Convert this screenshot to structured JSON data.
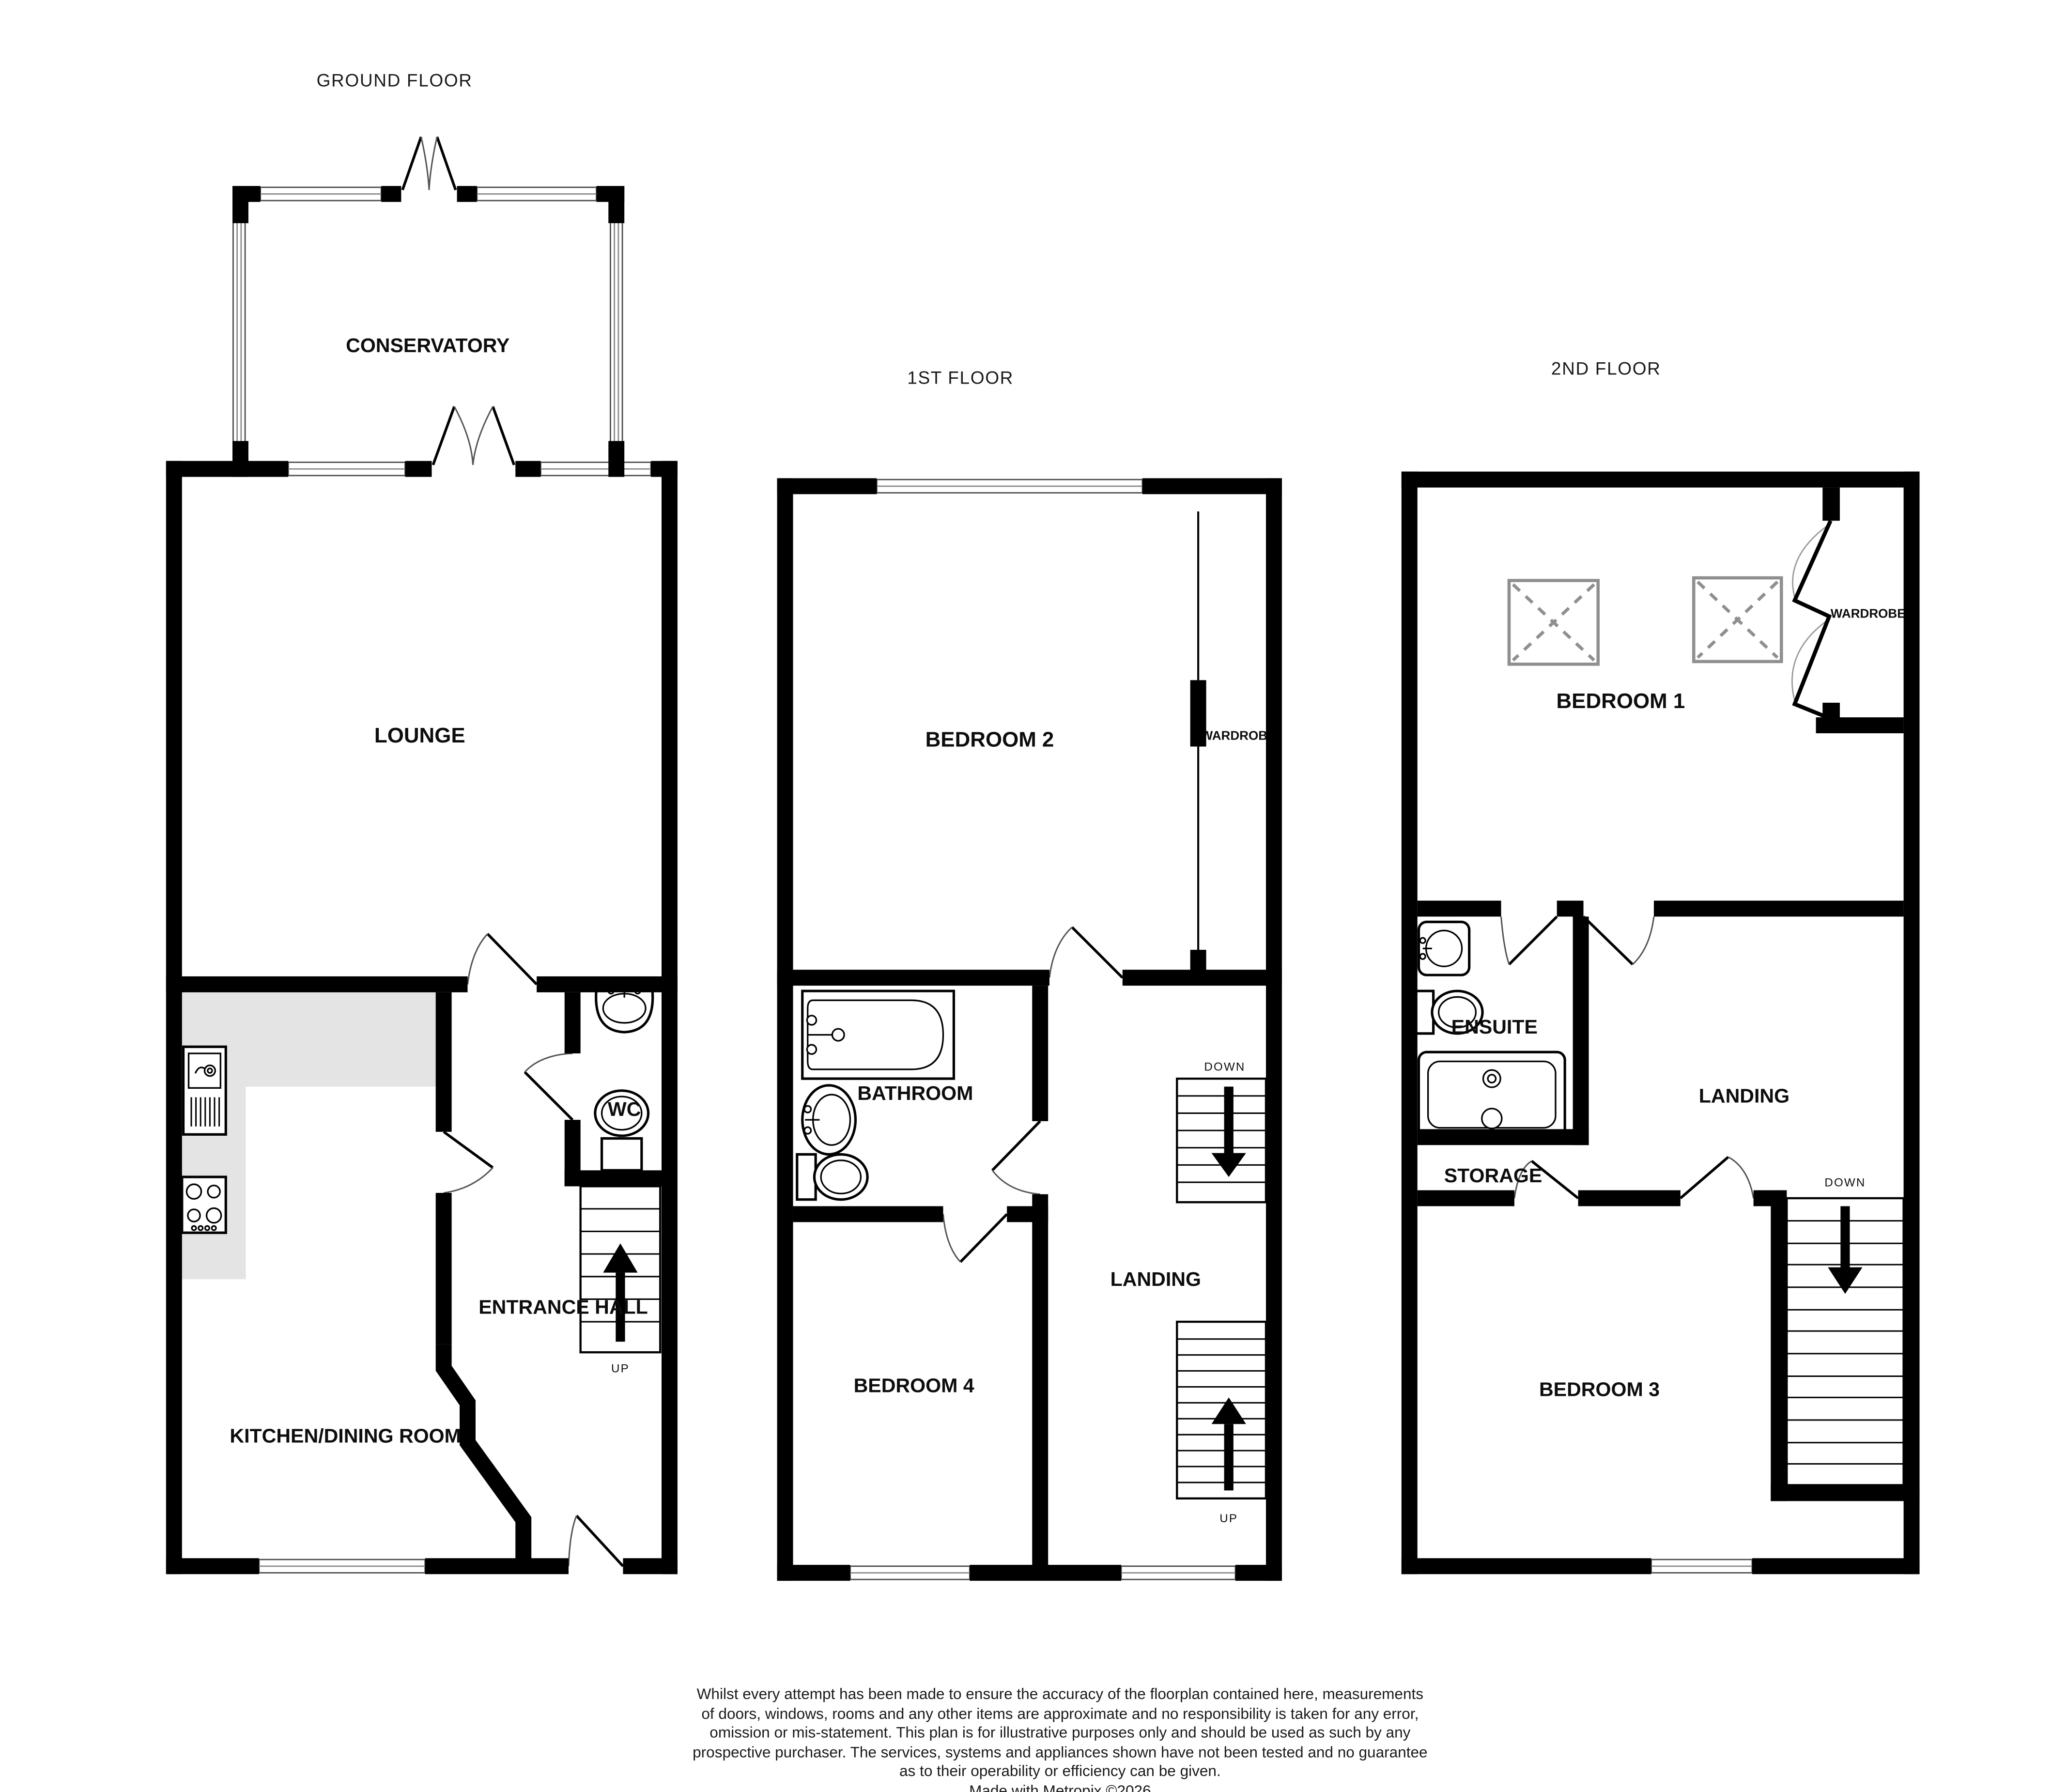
{
  "colors": {
    "wall": "#000000",
    "counter": "#e4e4e4",
    "skylight": "#8f8f8f",
    "background": "#ffffff"
  },
  "ground": {
    "title": "GROUND FLOOR",
    "labels": {
      "conservatory": "CONSERVATORY",
      "lounge": "LOUNGE",
      "kitchen": "KITCHEN/DINING ROOM",
      "wc": "WC",
      "entrance_hall": "ENTRANCE HALL"
    },
    "stairs": {
      "up": "UP"
    }
  },
  "first": {
    "title": "1ST FLOOR",
    "labels": {
      "bedroom2": "BEDROOM 2",
      "wardrobe": "WARDROBE",
      "bathroom": "BATHROOM",
      "landing": "LANDING",
      "bedroom4": "BEDROOM 4"
    },
    "stairs": {
      "down": "DOWN",
      "up": "UP"
    }
  },
  "second": {
    "title": "2ND FLOOR",
    "labels": {
      "bedroom1": "BEDROOM 1",
      "wardrobe": "WARDROBE",
      "ensuite": "ENSUITE",
      "landing": "LANDING",
      "storage": "STORAGE",
      "bedroom3": "BEDROOM 3"
    },
    "stairs": {
      "down": "DOWN"
    }
  },
  "disclaimer": {
    "line1": "Whilst every attempt has been made to ensure the accuracy of the floorplan contained here, measurements",
    "line2": "of doors, windows, rooms and any other items are approximate and no responsibility is taken for any error,",
    "line3": "omission or mis-statement. This plan is for illustrative purposes only and should be used as such by any",
    "line4": "prospective purchaser. The services, systems and appliances shown have not been tested and no guarantee",
    "line5": "as to their operability or efficiency can be given.",
    "credit": "Made with Metropix ©2026"
  }
}
